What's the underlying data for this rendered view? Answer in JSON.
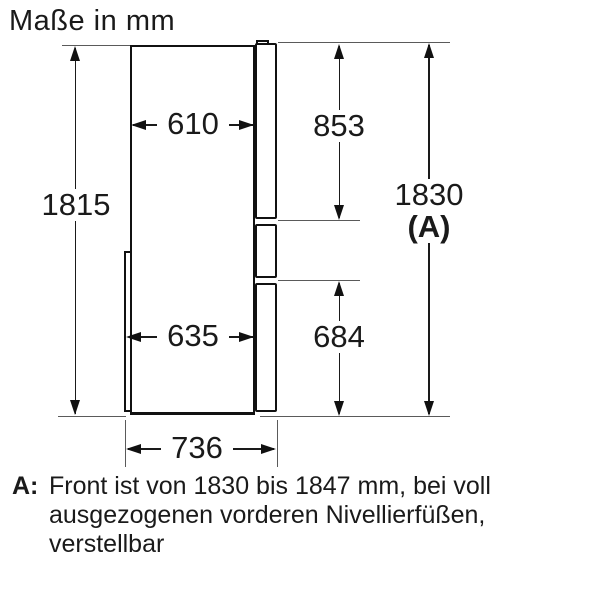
{
  "title": "Maße in mm",
  "dimensions": {
    "body_height": "1815",
    "body_depth_top": "610",
    "upper_door_height": "853",
    "total_height": "1830",
    "total_height_marker": "(A)",
    "body_depth_bottom": "635",
    "lower_door_height": "684",
    "total_depth": "736"
  },
  "footnote": {
    "label": "A:",
    "lines": [
      "Front ist von 1830 bis 1847 mm, bei voll",
      "ausgezogenen vorderen Nivellierfüßen,",
      "verstellbar"
    ]
  },
  "colors": {
    "line": "#111111",
    "background": "#ffffff"
  }
}
